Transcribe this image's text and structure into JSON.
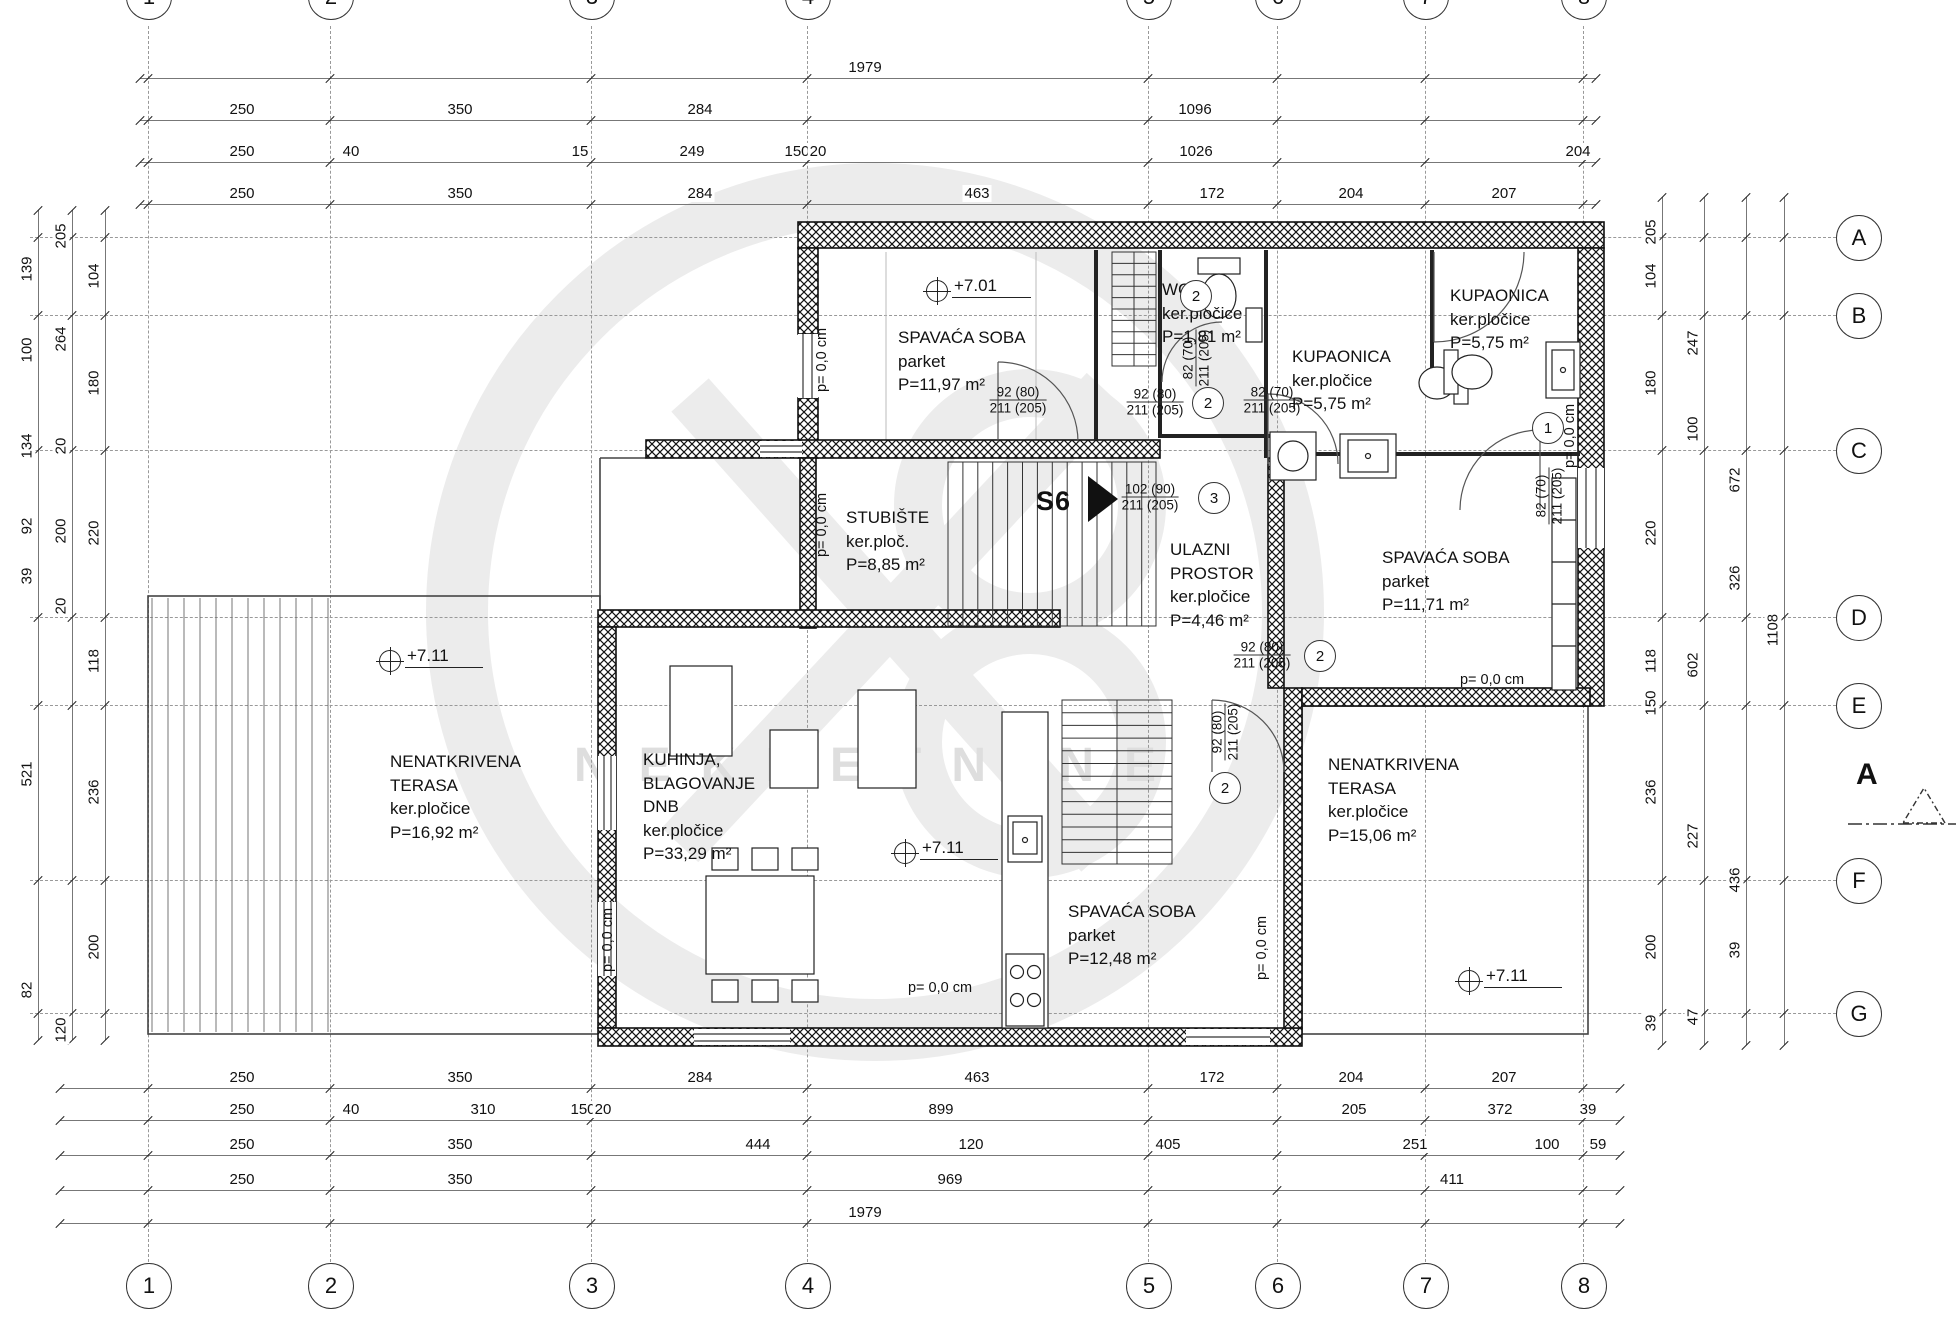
{
  "watermark": {
    "text": "NEKRETNINE"
  },
  "grid": {
    "cols": [
      {
        "label": "1",
        "x": 148
      },
      {
        "label": "2",
        "x": 330
      },
      {
        "label": "3",
        "x": 591
      },
      {
        "label": "4",
        "x": 807
      },
      {
        "label": "5",
        "x": 1148
      },
      {
        "label": "6",
        "x": 1277
      },
      {
        "label": "7",
        "x": 1425
      },
      {
        "label": "8",
        "x": 1583
      }
    ],
    "rows": [
      {
        "label": "A",
        "y": 237
      },
      {
        "label": "B",
        "y": 315
      },
      {
        "label": "C",
        "y": 450
      },
      {
        "label": "D",
        "y": 617
      },
      {
        "label": "E",
        "y": 705
      },
      {
        "label": "F",
        "y": 880
      },
      {
        "label": "G",
        "y": 1013
      }
    ],
    "section_marker": {
      "label": "A"
    }
  },
  "dim_rows": [
    {
      "y": 78,
      "x1": 140,
      "x2": 1596,
      "labels": [
        {
          "t": "1979",
          "x": 865
        }
      ]
    },
    {
      "y": 120,
      "x1": 140,
      "x2": 1596,
      "labels": [
        {
          "t": "250",
          "x": 242
        },
        {
          "t": "350",
          "x": 460
        },
        {
          "t": "284",
          "x": 700
        },
        {
          "t": "1096",
          "x": 1195
        }
      ]
    },
    {
      "y": 162,
      "x1": 140,
      "x2": 1596,
      "labels": [
        {
          "t": "250",
          "x": 242
        },
        {
          "t": "40",
          "x": 351
        },
        {
          "t": "15",
          "x": 580
        },
        {
          "t": "249",
          "x": 692
        },
        {
          "t": "150",
          "x": 797
        },
        {
          "t": "20",
          "x": 818
        },
        {
          "t": "1026",
          "x": 1196
        },
        {
          "t": "204",
          "x": 1578
        }
      ]
    },
    {
      "y": 204,
      "x1": 140,
      "x2": 1596,
      "labels": [
        {
          "t": "250",
          "x": 242
        },
        {
          "t": "350",
          "x": 460
        },
        {
          "t": "284",
          "x": 700
        },
        {
          "t": "463",
          "x": 977
        },
        {
          "t": "172",
          "x": 1212
        },
        {
          "t": "204",
          "x": 1351
        },
        {
          "t": "207",
          "x": 1504
        }
      ]
    },
    {
      "y": 1088,
      "x1": 60,
      "x2": 1620,
      "labels": [
        {
          "t": "250",
          "x": 242
        },
        {
          "t": "350",
          "x": 460
        },
        {
          "t": "284",
          "x": 700
        },
        {
          "t": "463",
          "x": 977
        },
        {
          "t": "172",
          "x": 1212
        },
        {
          "t": "204",
          "x": 1351
        },
        {
          "t": "207",
          "x": 1504
        }
      ]
    },
    {
      "y": 1120,
      "x1": 60,
      "x2": 1620,
      "labels": [
        {
          "t": "250",
          "x": 242
        },
        {
          "t": "40",
          "x": 351
        },
        {
          "t": "310",
          "x": 483
        },
        {
          "t": "150",
          "x": 583
        },
        {
          "t": "20",
          "x": 603
        },
        {
          "t": "899",
          "x": 941
        },
        {
          "t": "205",
          "x": 1354
        },
        {
          "t": "372",
          "x": 1500
        },
        {
          "t": "39",
          "x": 1588
        }
      ]
    },
    {
      "y": 1155,
      "x1": 60,
      "x2": 1620,
      "labels": [
        {
          "t": "250",
          "x": 242
        },
        {
          "t": "350",
          "x": 460
        },
        {
          "t": "444",
          "x": 758
        },
        {
          "t": "120",
          "x": 971
        },
        {
          "t": "405",
          "x": 1168
        },
        {
          "t": "251",
          "x": 1415
        },
        {
          "t": "100",
          "x": 1547
        },
        {
          "t": "59",
          "x": 1598
        }
      ]
    },
    {
      "y": 1190,
      "x1": 60,
      "x2": 1620,
      "labels": [
        {
          "t": "250",
          "x": 242
        },
        {
          "t": "350",
          "x": 460
        },
        {
          "t": "969",
          "x": 950
        },
        {
          "t": "411",
          "x": 1452
        }
      ]
    },
    {
      "y": 1223,
      "x1": 60,
      "x2": 1620,
      "labels": [
        {
          "t": "1979",
          "x": 865
        }
      ]
    }
  ],
  "dim_cols": [
    {
      "x": 38,
      "y1": 210,
      "y2": 1040,
      "labels": [
        {
          "t": "139",
          "y": 269
        },
        {
          "t": "100",
          "y": 350
        },
        {
          "t": "134",
          "y": 446
        },
        {
          "t": "92",
          "y": 526
        },
        {
          "t": "39",
          "y": 576
        },
        {
          "t": "521",
          "y": 774
        },
        {
          "t": "82",
          "y": 990
        }
      ]
    },
    {
      "x": 72,
      "y1": 210,
      "y2": 1040,
      "labels": [
        {
          "t": "205",
          "y": 236
        },
        {
          "t": "264",
          "y": 339
        },
        {
          "t": "20",
          "y": 446
        },
        {
          "t": "200",
          "y": 531
        },
        {
          "t": "20",
          "y": 606
        },
        {
          "t": "120",
          "y": 1030
        }
      ]
    },
    {
      "x": 105,
      "y1": 210,
      "y2": 1040,
      "labels": [
        {
          "t": "104",
          "y": 276
        },
        {
          "t": "180",
          "y": 383
        },
        {
          "t": "220",
          "y": 533
        },
        {
          "t": "118",
          "y": 661
        },
        {
          "t": "236",
          "y": 792
        },
        {
          "t": "200",
          "y": 947
        }
      ]
    },
    {
      "x": 1662,
      "y1": 197,
      "y2": 1045,
      "labels": [
        {
          "t": "205",
          "y": 232
        },
        {
          "t": "104",
          "y": 276
        },
        {
          "t": "180",
          "y": 383
        },
        {
          "t": "220",
          "y": 533
        },
        {
          "t": "118",
          "y": 661
        },
        {
          "t": "150",
          "y": 703
        },
        {
          "t": "236",
          "y": 792
        },
        {
          "t": "200",
          "y": 947
        },
        {
          "t": "39",
          "y": 1023
        }
      ]
    },
    {
      "x": 1704,
      "y1": 197,
      "y2": 1045,
      "labels": [
        {
          "t": "247",
          "y": 343
        },
        {
          "t": "100",
          "y": 429
        },
        {
          "t": "602",
          "y": 665
        },
        {
          "t": "227",
          "y": 836
        },
        {
          "t": "47",
          "y": 1017
        }
      ]
    },
    {
      "x": 1746,
      "y1": 197,
      "y2": 1045,
      "labels": [
        {
          "t": "672",
          "y": 480
        },
        {
          "t": "326",
          "y": 578
        },
        {
          "t": "436",
          "y": 880
        },
        {
          "t": "39",
          "y": 950
        }
      ]
    },
    {
      "x": 1784,
      "y1": 197,
      "y2": 1045,
      "labels": [
        {
          "t": "1108",
          "y": 630
        }
      ]
    }
  ],
  "rooms": [
    {
      "lines": [
        "SPAVAĆA SOBA",
        "parket",
        "P=11,97 m²"
      ],
      "x": 898,
      "y": 326
    },
    {
      "lines": [
        "WC",
        "ker.pločice",
        "P=1,81 m²"
      ],
      "x": 1162,
      "y": 278
    },
    {
      "lines": [
        "KUPAONICA",
        "ker.pločice",
        "P=5,75 m²"
      ],
      "x": 1292,
      "y": 345
    },
    {
      "lines": [
        "KUPAONICA",
        "ker.pločice",
        "P=5,75 m²"
      ],
      "x": 1450,
      "y": 284
    },
    {
      "lines": [
        "STUBIŠTE",
        "ker.ploč.",
        "P=8,85 m²"
      ],
      "x": 846,
      "y": 506
    },
    {
      "lines": [
        "ULAZNI",
        "PROSTOR",
        "ker.pločice",
        "P=4,46 m²"
      ],
      "x": 1170,
      "y": 538
    },
    {
      "lines": [
        "SPAVAĆA SOBA",
        "parket",
        "P=11,71 m²"
      ],
      "x": 1382,
      "y": 546
    },
    {
      "lines": [
        "KUHINJA,",
        "BLAGOVANJE",
        "DNB",
        "ker.pločice",
        "P=33,29 m²"
      ],
      "x": 643,
      "y": 748
    },
    {
      "lines": [
        "NENATKRIVENA",
        "TERASA",
        "ker.pločice",
        "P=16,92 m²"
      ],
      "x": 390,
      "y": 750
    },
    {
      "lines": [
        "NENATKRIVENA",
        "TERASA",
        "ker.pločice",
        "P=15,06 m²"
      ],
      "x": 1328,
      "y": 753
    },
    {
      "lines": [
        "SPAVAĆA SOBA",
        "parket",
        "P=12,48 m²"
      ],
      "x": 1068,
      "y": 900
    }
  ],
  "elevations": [
    {
      "t": "+7.01",
      "x": 952,
      "y": 276
    },
    {
      "t": "+7.11",
      "x": 405,
      "y": 646
    },
    {
      "t": "+7.11",
      "x": 920,
      "y": 838
    },
    {
      "t": "+7.11",
      "x": 1484,
      "y": 966
    }
  ],
  "floor_notes": [
    {
      "t": "p= 0,0 cm",
      "x": 822,
      "y": 360,
      "v": true
    },
    {
      "t": "p= 0,0 cm",
      "x": 822,
      "y": 525,
      "v": true
    },
    {
      "t": "p= 0,0 cm",
      "x": 608,
      "y": 940,
      "v": true
    },
    {
      "t": "p= 0,0 cm",
      "x": 1262,
      "y": 948,
      "v": true
    },
    {
      "t": "p= 0,0 cm",
      "x": 1570,
      "y": 436,
      "v": true
    },
    {
      "t": "p= 0,0 cm",
      "x": 940,
      "y": 988,
      "v": false
    },
    {
      "t": "p= 0,0 cm",
      "x": 1492,
      "y": 680,
      "v": false
    }
  ],
  "door_labels": [
    {
      "top": "92 (80)",
      "bottom": "211 (205)",
      "x": 1018,
      "y": 400,
      "v": false,
      "num": ""
    },
    {
      "top": "92 (80)",
      "bottom": "211 (205)",
      "x": 1155,
      "y": 402,
      "v": false,
      "num": "2",
      "nx": 1208,
      "ny": 403
    },
    {
      "top": "82 (70)",
      "bottom": "211 (205)",
      "x": 1272,
      "y": 400,
      "v": false,
      "num": ""
    },
    {
      "top": "102 (90)",
      "bottom": "211 (205)",
      "x": 1150,
      "y": 497,
      "v": false,
      "num": "3",
      "nx": 1214,
      "ny": 498
    },
    {
      "top": "82 (70)",
      "bottom": "211 (205)",
      "x": 1196,
      "y": 358,
      "v": true,
      "num": "2",
      "nx": 1196,
      "ny": 296
    },
    {
      "top": "82 (70)",
      "bottom": "211 (205)",
      "x": 1549,
      "y": 496,
      "v": true,
      "num": "1",
      "nx": 1548,
      "ny": 428
    },
    {
      "top": "92 (80)",
      "bottom": "211 (205)",
      "x": 1262,
      "y": 655,
      "v": false,
      "num": "2",
      "nx": 1320,
      "ny": 656
    },
    {
      "top": "92 (80)",
      "bottom": "211 (205)",
      "x": 1225,
      "y": 732,
      "v": true,
      "num": "2",
      "nx": 1225,
      "ny": 788
    }
  ],
  "stair_label": {
    "t": "S6",
    "x": 1036,
    "y": 486
  }
}
